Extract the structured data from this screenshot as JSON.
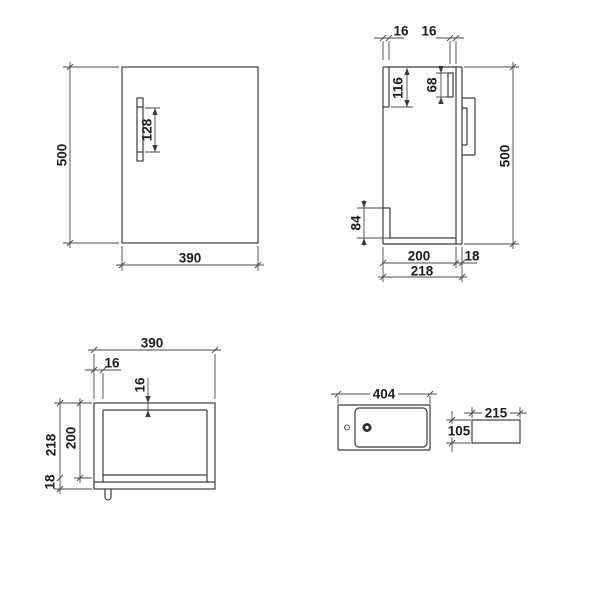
{
  "drawing": {
    "front_view": {
      "label_height": "500",
      "label_width": "390",
      "label_handle": "128"
    },
    "side_view": {
      "label_back_thickness": "16",
      "label_front_thickness": "16",
      "label_cutout": "116",
      "label_handle_plate": "68",
      "label_notch": "84",
      "label_height": "500",
      "label_body_depth": "200",
      "label_door": "18",
      "label_total_depth": "218"
    },
    "plan_view": {
      "label_width": "390",
      "label_side_wall": "16",
      "label_back_wall": "16",
      "label_total_depth": "218",
      "label_body_depth": "200",
      "label_door": "18"
    },
    "basin_top_view": {
      "label_width": "404"
    },
    "basin_side_view": {
      "label_width": "215",
      "label_height": "105"
    },
    "line_color": "#3c3c3c"
  }
}
